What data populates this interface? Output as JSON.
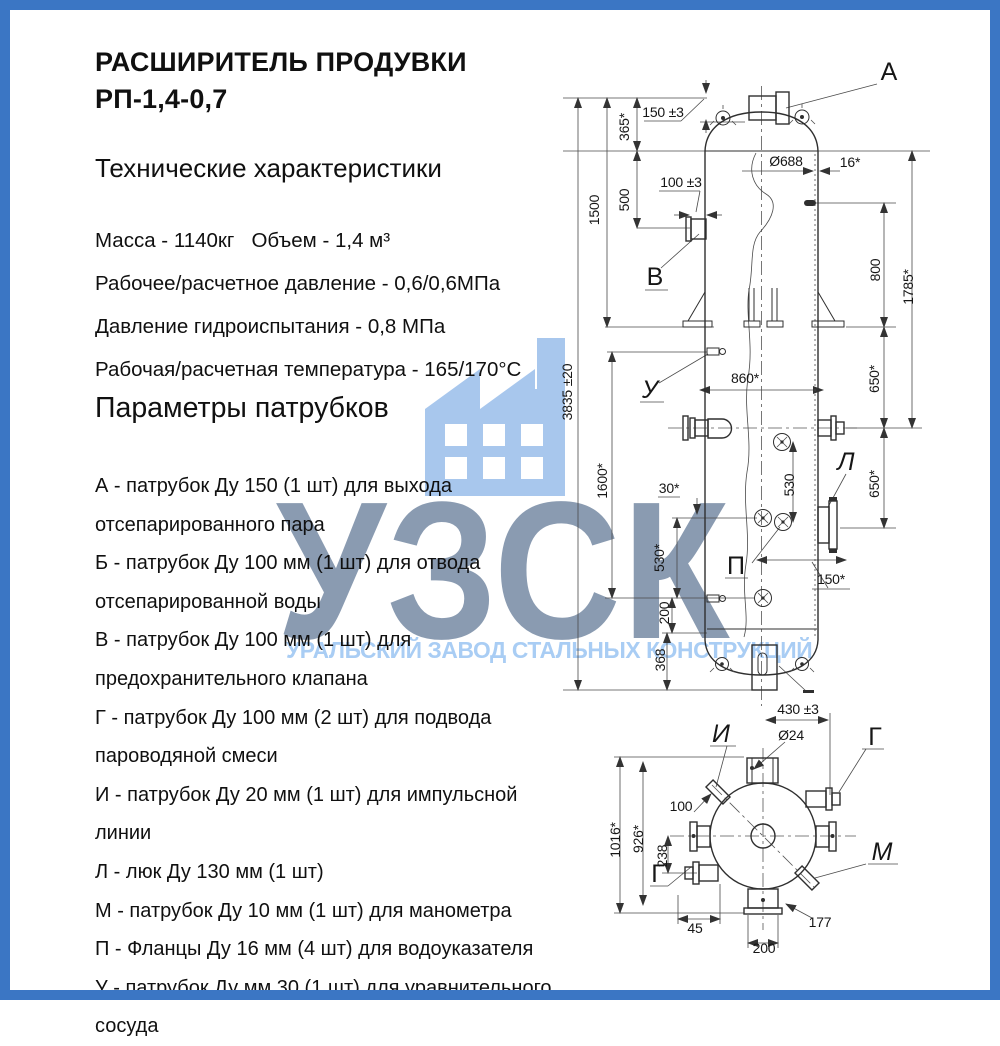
{
  "colors": {
    "border": "#3b76c4",
    "icon_blue": "#a8c7ed",
    "abbr_gray_blue": "#8a9bb1",
    "tagline_blue": "#a9cdf4"
  },
  "header": {
    "title_line1": "РАСШИРИТЕЛЬ ПРОДУВКИ",
    "title_line2": "РП-1,4-0,7"
  },
  "specs": {
    "heading": "Технические характеристики",
    "lines": [
      "Масса - 1140кг   Объем - 1,4 м³",
      "Рабочее/расчетное давление - 0,6/0,6МПа",
      "Давление гидроиспытания - 0,8 МПа",
      "Рабочая/расчетная температура - 165/170°С"
    ]
  },
  "nozzles": {
    "heading": "Параметры патрубков",
    "items": [
      "А - патрубок Ду 150 (1 шт) для выхода отсепарированного пара",
      "Б - патрубок Ду 100 мм (1 шт) для отвода отсепарированной воды",
      "В - патрубок Ду 100 мм (1 шт) для предохранительного клапана",
      "Г - патрубок Ду 100 мм (2 шт) для подвода пароводяной смеси",
      "И - патрубок Ду 20 мм (1 шт) для импульсной линии",
      "Л - люк Ду 130 мм (1 шт)",
      "М - патрубок Ду 10 мм (1 шт) для манометра",
      "П - Фланцы Ду 16 мм (4 шт) для водоуказателя",
      "У - патрубок Ду мм 30 (1 шт) для уравнительного сосуда"
    ]
  },
  "watermark": {
    "abbr": "УЗСК",
    "tagline": "УРАЛЬСКИЙ ЗАВОД СТАЛЬНЫХ КОНСТРУКЦИЙ",
    "icon": "factory-icon"
  },
  "drawing": {
    "view_labels": [
      {
        "t": "А",
        "x": 889,
        "y": 80,
        "it": 0
      },
      {
        "t": "В",
        "x": 655,
        "y": 285,
        "it": 0
      },
      {
        "t": "У",
        "x": 650,
        "y": 398,
        "it": 1
      },
      {
        "t": "Л",
        "x": 846,
        "y": 470,
        "it": 1
      },
      {
        "t": "П",
        "x": 736,
        "y": 574,
        "it": 0
      },
      {
        "t": "И",
        "x": 721,
        "y": 742,
        "it": 1
      },
      {
        "t": "Г",
        "x": 875,
        "y": 745,
        "it": 0
      },
      {
        "t": "М",
        "x": 882,
        "y": 860,
        "it": 1
      },
      {
        "t": "Г",
        "x": 658,
        "y": 882,
        "it": 0
      }
    ],
    "dim_labels": [
      {
        "t": "150 ±3",
        "x": 663,
        "y": 117,
        "r": 0
      },
      {
        "t": "365*",
        "x": 629,
        "y": 127,
        "r": -90
      },
      {
        "t": "500",
        "x": 629,
        "y": 200,
        "r": -90
      },
      {
        "t": "1500",
        "x": 599,
        "y": 210,
        "r": -90
      },
      {
        "t": "3835 ±20",
        "x": 572,
        "y": 392,
        "r": -90
      },
      {
        "t": "100 ±3",
        "x": 681,
        "y": 187,
        "r": 0
      },
      {
        "t": "Ø688",
        "x": 786,
        "y": 166,
        "r": 0
      },
      {
        "t": "16*",
        "x": 850,
        "y": 167,
        "r": 0
      },
      {
        "t": "800",
        "x": 880,
        "y": 270,
        "r": -90
      },
      {
        "t": "1785*",
        "x": 913,
        "y": 287,
        "r": -90
      },
      {
        "t": "650*",
        "x": 879,
        "y": 379,
        "r": -90
      },
      {
        "t": "860*",
        "x": 745,
        "y": 383,
        "r": 0
      },
      {
        "t": "1600*",
        "x": 607,
        "y": 481,
        "r": -90
      },
      {
        "t": "650*",
        "x": 879,
        "y": 484,
        "r": -90
      },
      {
        "t": "530",
        "x": 794,
        "y": 485,
        "r": -90
      },
      {
        "t": "30*",
        "x": 669,
        "y": 493,
        "r": 0
      },
      {
        "t": "530*",
        "x": 664,
        "y": 558,
        "r": -90
      },
      {
        "t": "150*",
        "x": 831,
        "y": 584,
        "r": 0
      },
      {
        "t": "200",
        "x": 669,
        "y": 613,
        "r": -90
      },
      {
        "t": "368",
        "x": 665,
        "y": 660,
        "r": -90
      },
      {
        "t": "430 ±3",
        "x": 798,
        "y": 714,
        "r": 0
      },
      {
        "t": "Ø24",
        "x": 791,
        "y": 740,
        "r": 0
      },
      {
        "t": "1016*",
        "x": 620,
        "y": 840,
        "r": -90
      },
      {
        "t": "926*",
        "x": 643,
        "y": 839,
        "r": -90
      },
      {
        "t": "238",
        "x": 667,
        "y": 856,
        "r": -90
      },
      {
        "t": "100",
        "x": 681,
        "y": 811,
        "r": 0
      },
      {
        "t": "45",
        "x": 695,
        "y": 933,
        "r": 0
      },
      {
        "t": "200",
        "x": 764,
        "y": 953,
        "r": 0
      },
      {
        "t": "177",
        "x": 820,
        "y": 927,
        "r": 0
      }
    ]
  }
}
